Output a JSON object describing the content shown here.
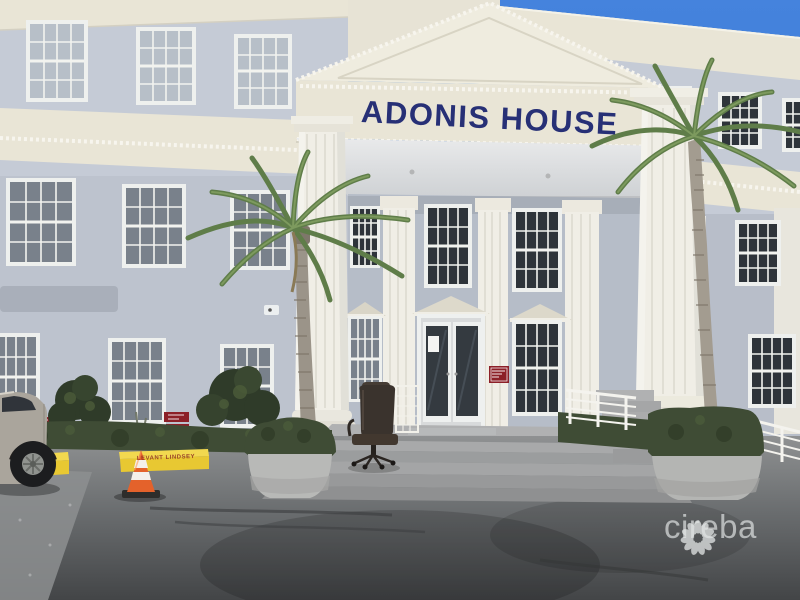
{
  "photo": {
    "description": "Street-level exterior photograph of a three-storey grey office building with a classical white-columned portico entrance, palm trees, entrance steps, an office chair by the door, a traffic cone and an asphalt parking lot in the foreground.",
    "building_sign": "ADONIS HOUSE",
    "curb_text": "LEVANT LINDSEY",
    "watermark_brand": "cireba"
  },
  "colors": {
    "sky": "#3f7ed8",
    "sky_top": "#4583dd",
    "facade": "#c5cbd6",
    "facade_recessed": "#b6bdc8",
    "trim_cream": "#e9e5d6",
    "pediment_cream": "#efecdf",
    "column_white": "#f0eee6",
    "sign_navy": "#273076",
    "window_frame": "#eef0ee",
    "hedge_green": "#3f4c35",
    "palm_green": "#5f7d49",
    "asphalt": "#55585a",
    "concrete_steps": "#a2a4a5",
    "curb_yellow": "#e8c832",
    "curb_text_red": "#8d2b22",
    "cone_orange": "#e4622b",
    "sign_red": "#8c2028",
    "watermark_white": "#e3e6e6"
  },
  "visible_objects": [
    "building facade",
    "pediment portico",
    "fluted columns",
    "double glass entrance doors",
    "grid sash windows",
    "palm trees",
    "hedges and planters",
    "entrance steps",
    "white ramp railing",
    "office chair",
    "white trellis",
    "traffic cone",
    "parked car",
    "yellow parking curbs",
    "red reserved-parking signs",
    "security cameras",
    "asphalt parking lot",
    "cireba watermark"
  ]
}
